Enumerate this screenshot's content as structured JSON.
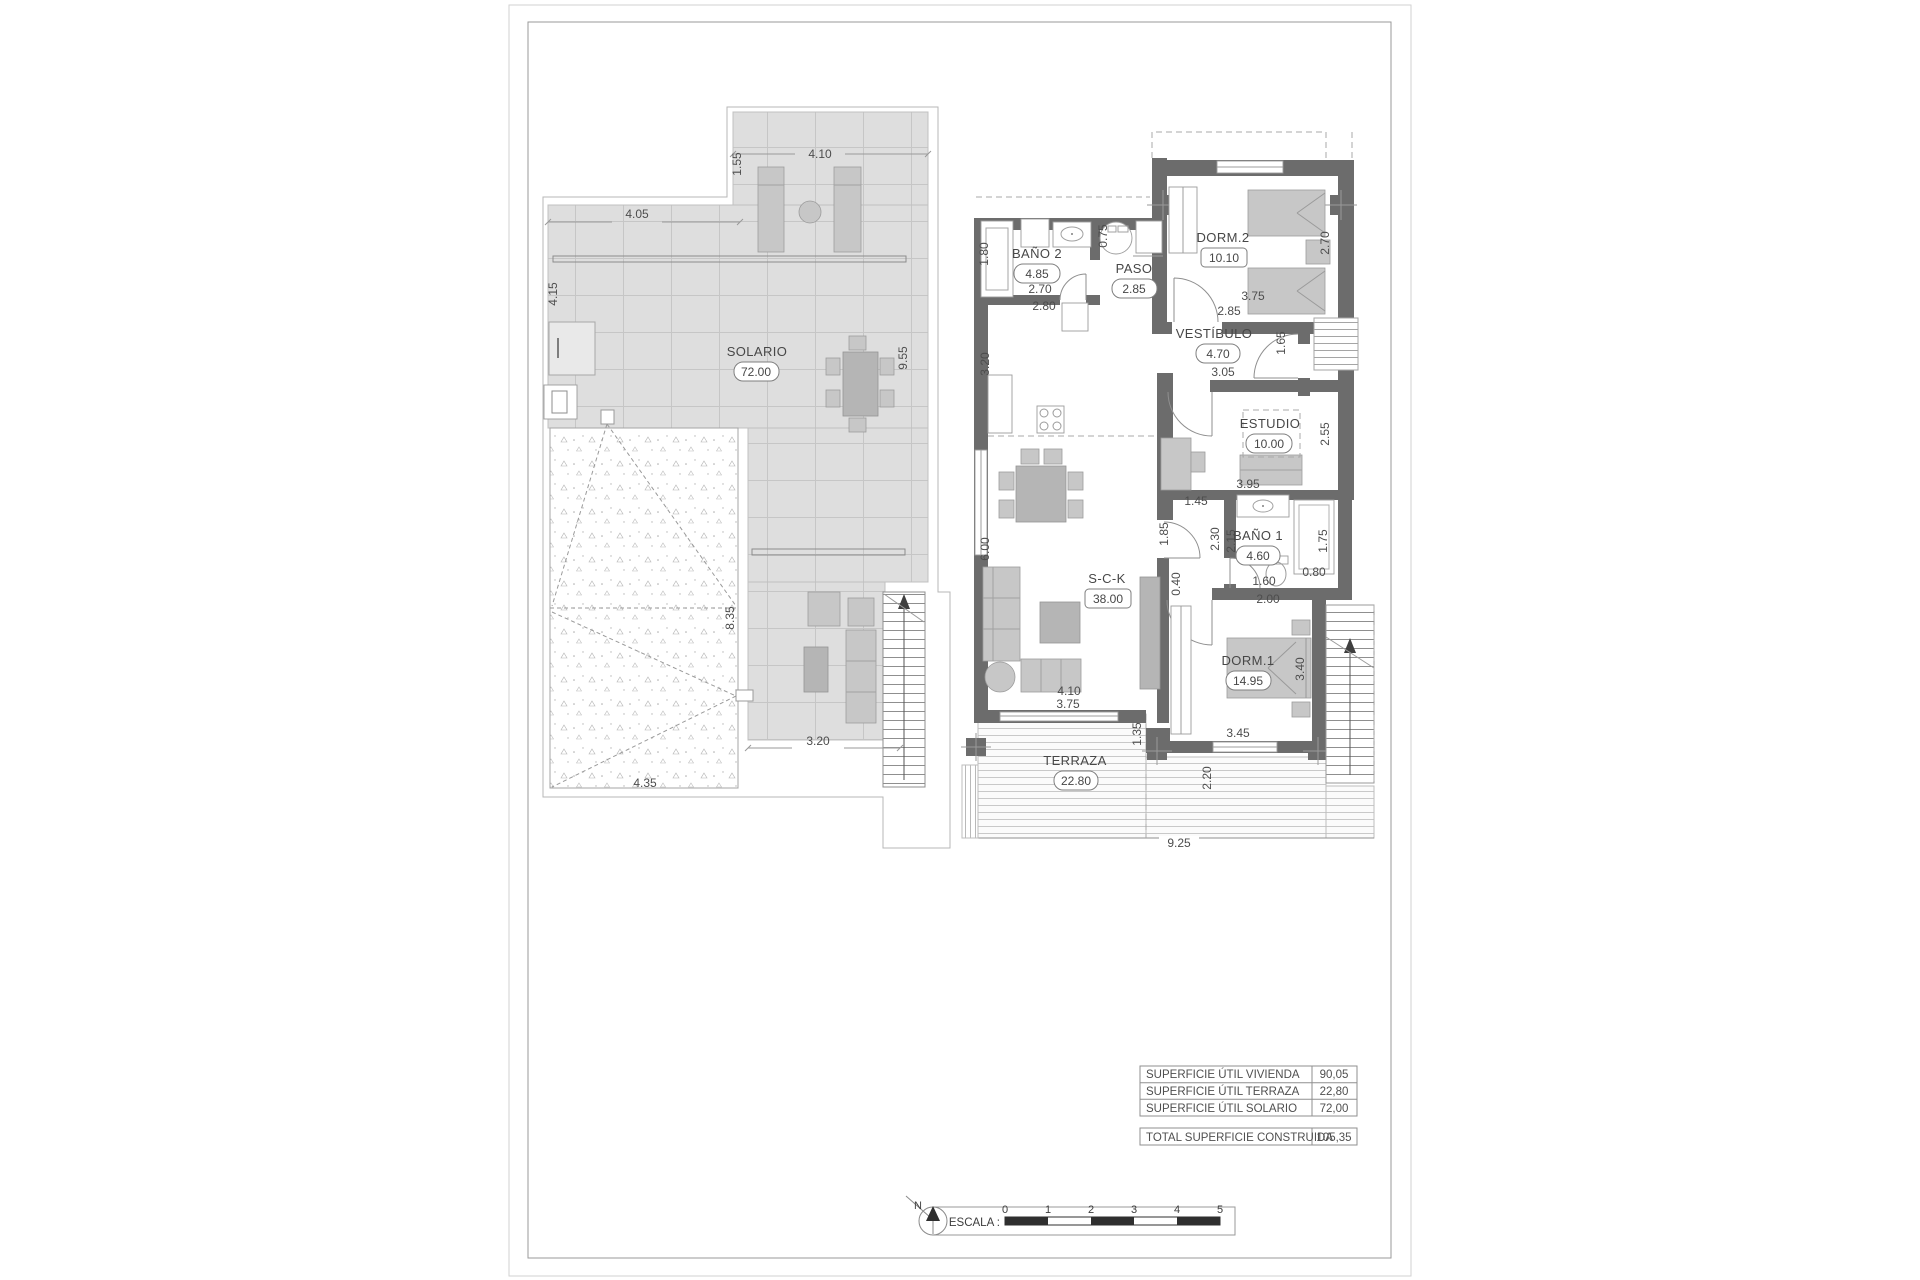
{
  "drawing": {
    "solario": {
      "name": "SOLARIO",
      "area": "72.00",
      "dims": {
        "top": "4.10",
        "top_height": "1.55",
        "upper_width": "4.05",
        "left_height": "4.15",
        "right_height": "9.55",
        "roof_height": "8.35",
        "roof_width": "4.35",
        "bottom_width": "3.20"
      }
    },
    "floor": {
      "rooms": {
        "bano2": {
          "name": "BAÑO 2",
          "area": "4.85"
        },
        "paso": {
          "name": "PASO",
          "area": "2.85"
        },
        "dorm2": {
          "name": "DORM.2",
          "area": "10.10"
        },
        "vestibulo": {
          "name": "VESTÍBULO",
          "area": "4.70"
        },
        "estudio": {
          "name": "ESTUDIO",
          "area": "10.00"
        },
        "bano1": {
          "name": "BAÑO 1",
          "area": "4.60"
        },
        "sck": {
          "name": "S-C-K",
          "area": "38.00"
        },
        "dorm1": {
          "name": "DORM.1",
          "area": "14.95"
        },
        "terraza": {
          "name": "TERRAZA",
          "area": "22.80"
        }
      },
      "dims": {
        "bano2_height": "1.80",
        "bano2_w1": "2.70",
        "bano2_w2": "2.80",
        "kitchen_height": "3.20",
        "paso_niche": "0.75",
        "dorm2_bottom1": "3.75",
        "dorm2_bottom2": "2.85",
        "dorm2_right": "2.70",
        "vest_width": "3.05",
        "vest_door": "1.65",
        "estudio_right": "2.55",
        "estudio_width": "3.95",
        "hall_width": "1.45",
        "sck_door": "1.85",
        "hall_len1": "2.30",
        "hall_len2": "2.15",
        "wall_step": "0.40",
        "bano1_w1": "1.60",
        "bano1_w2": "2.00",
        "shower_width": "0.80",
        "bano1_height": "1.75",
        "sck_height": "6.00",
        "sck_width": "4.10",
        "dorm1_height": "3.40",
        "dorm1_width": "3.45",
        "terraza_left_w": "3.75",
        "terraza_step": "1.35",
        "terraza_right_h": "2.20",
        "terraza_width": "9.25"
      }
    },
    "areas_table": {
      "rows": [
        {
          "label": "SUPERFICIE ÚTIL VIVIENDA",
          "value": "90,05"
        },
        {
          "label": "SUPERFICIE ÚTIL TERRAZA",
          "value": "22,80"
        },
        {
          "label": "SUPERFICIE ÚTIL SOLARIO",
          "value": "72,00"
        }
      ],
      "total_label": "TOTAL SUPERFICIE CONSTRUIDA",
      "total_value": "105,35"
    },
    "scale_bar": {
      "north": "N",
      "label": "ESCALA :",
      "ticks": [
        "0",
        "1",
        "2",
        "3",
        "4",
        "5"
      ]
    }
  }
}
